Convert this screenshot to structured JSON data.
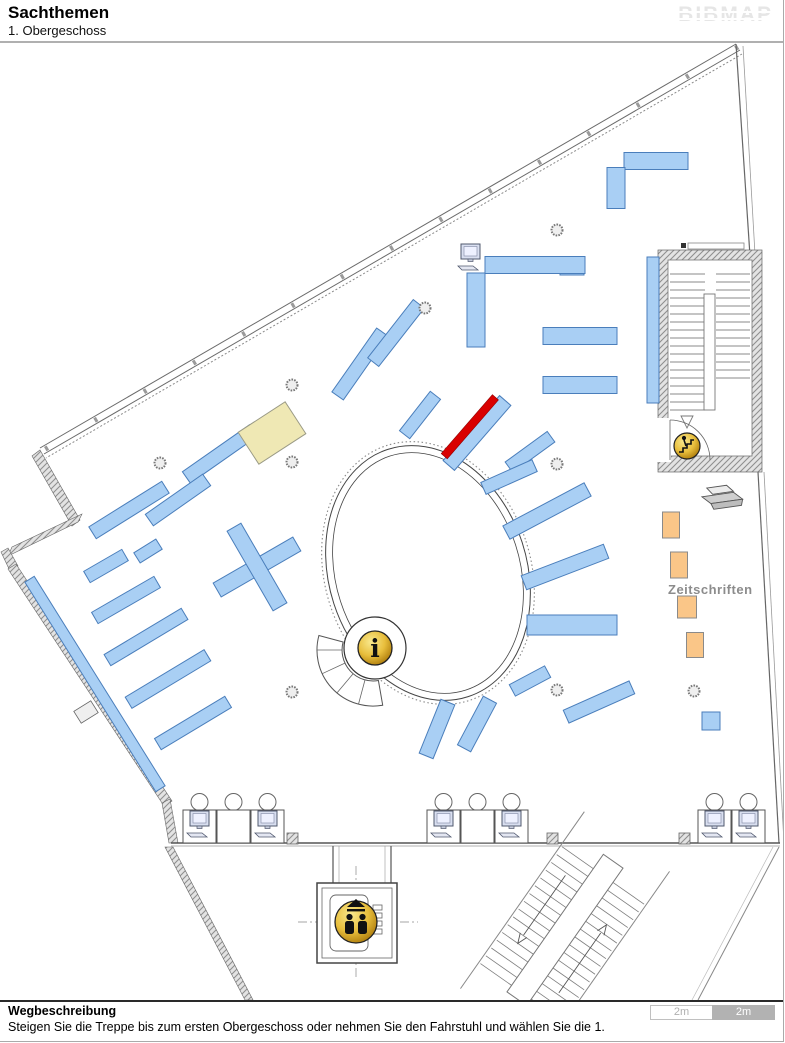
{
  "header": {
    "title": "Sachthemen",
    "subtitle": "1. Obergeschoss",
    "logo": "BIBMAP"
  },
  "footer": {
    "heading": "Wegbeschreibung",
    "description": "Steigen Sie die Treppe bis zum ersten Obergeschoss oder nehmen Sie den Fahrstuhl und wählen Sie die 1.",
    "scale_left": "2m",
    "scale_right": "2m"
  },
  "map": {
    "labels": {
      "zeitschriften": "Zeitschriften"
    },
    "icons": [
      "info-icon",
      "stairs-icon",
      "elevator-icon",
      "computer-icon",
      "printer-icon"
    ],
    "colors": {
      "shelf": "#A9CFF4",
      "shelf_border": "#4A7EBB",
      "highlight": "#D90000",
      "highlight_border": "#8f0000",
      "table": "#EFE8B4",
      "table_border": "#9a9a85",
      "magazine": "#FAC688",
      "magazine_border": "#8a8a8a",
      "gold": "#E8BE3C",
      "wall": "#9a9a9a"
    },
    "shelves": [
      [
        656,
        161,
        64,
        17,
        0
      ],
      [
        616,
        188,
        18,
        41,
        0
      ],
      [
        653,
        330,
        12,
        146,
        0
      ],
      [
        572,
        266,
        24,
        18,
        0
      ],
      [
        535,
        265,
        100,
        17,
        0
      ],
      [
        476,
        310,
        18,
        74,
        0
      ],
      [
        580,
        336,
        74,
        17,
        0
      ],
      [
        580,
        385,
        74,
        17,
        0
      ],
      [
        360,
        364,
        78,
        14,
        -55
      ],
      [
        396,
        333,
        74,
        14,
        -52
      ],
      [
        420,
        415,
        50,
        13,
        -52
      ],
      [
        477,
        433,
        86,
        15,
        -49,
        "highlight"
      ],
      [
        530,
        452,
        52,
        13,
        -36
      ],
      [
        509,
        477,
        56,
        13,
        -24
      ],
      [
        547,
        511,
        92,
        15,
        -28
      ],
      [
        565,
        567,
        88,
        15,
        -21
      ],
      [
        572,
        625,
        90,
        20,
        0
      ],
      [
        530,
        681,
        40,
        13,
        -28
      ],
      [
        599,
        702,
        72,
        14,
        -24
      ],
      [
        437,
        729,
        58,
        15,
        -68
      ],
      [
        477,
        724,
        55,
        15,
        -62
      ],
      [
        220,
        454,
        82,
        14,
        -35
      ],
      [
        178,
        500,
        70,
        14,
        -35
      ],
      [
        129,
        510,
        86,
        14,
        -32
      ],
      [
        148,
        551,
        26,
        12,
        -32
      ],
      [
        106,
        566,
        44,
        13,
        -30
      ],
      [
        126,
        600,
        72,
        13,
        -30
      ],
      [
        146,
        637,
        90,
        13,
        -31
      ],
      [
        168,
        679,
        92,
        13,
        -31
      ],
      [
        193,
        723,
        82,
        13,
        -31
      ],
      [
        95,
        684,
        247,
        11,
        58
      ],
      [
        272,
        433,
        56,
        38,
        -33,
        "table"
      ],
      [
        257,
        567,
        92,
        16,
        -30
      ],
      [
        257,
        567,
        92,
        16,
        60
      ],
      [
        671,
        525,
        17,
        26,
        0,
        "magazine"
      ],
      [
        679,
        565,
        17,
        26,
        0,
        "magazine"
      ],
      [
        687,
        607,
        19,
        22,
        0,
        "magazine"
      ],
      [
        695,
        645,
        17,
        25,
        0,
        "magazine"
      ],
      [
        711,
        721,
        18,
        18,
        0
      ]
    ],
    "columns": [
      [
        160,
        463
      ],
      [
        292,
        385
      ],
      [
        292,
        462
      ],
      [
        425,
        308
      ],
      [
        557,
        230
      ],
      [
        557,
        464
      ],
      [
        557,
        690
      ],
      [
        292,
        692
      ],
      [
        694,
        691
      ]
    ],
    "desk_groups": [
      {
        "x": 183,
        "y": 810,
        "monitors": [
          true,
          false,
          true
        ]
      },
      {
        "x": 427,
        "y": 810,
        "monitors": [
          true,
          false,
          true
        ]
      },
      {
        "x": 698,
        "y": 810,
        "monitors": [
          true,
          true
        ]
      }
    ],
    "wall_posts": [
      [
        287,
        833
      ],
      [
        547,
        833
      ],
      [
        679,
        833
      ]
    ]
  }
}
